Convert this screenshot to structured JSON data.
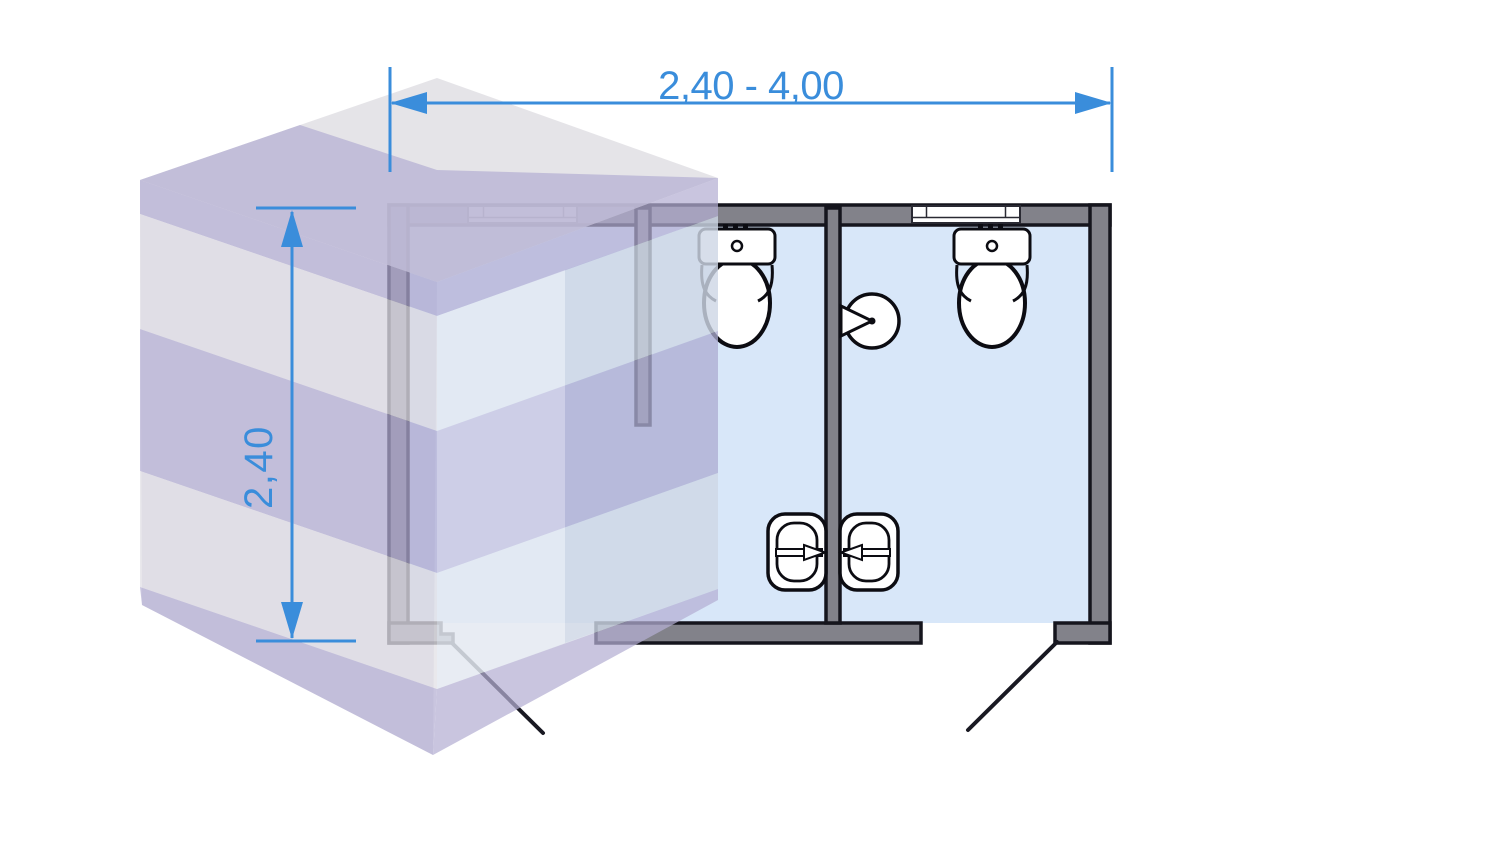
{
  "drawing": {
    "type": "sanitary-container floor plan with 3d isometric volume",
    "dimensions": {
      "width": {
        "label": "2,40 - 4,00"
      },
      "height": {
        "label": "2,40"
      }
    },
    "plan": {
      "rooms_count": 3,
      "windows_count": 2,
      "doors_count": 2,
      "fixtures": [
        {
          "name": "toilet-1"
        },
        {
          "name": "toilet-2"
        },
        {
          "name": "wash-basin-left"
        },
        {
          "name": "wash-basin-right"
        },
        {
          "name": "toilet-paper-holder"
        }
      ]
    },
    "colors": {
      "dimension_blue": "#3a8ddb",
      "wall_gray": "#82828a",
      "wall_outline": "#15151d",
      "floor_blue": "#d8e7f9",
      "cube_lavender": "#b4afd2",
      "cube_gray": "#e3e2e7",
      "cube_pale_blue": "#dde3ec",
      "fixture_white": "#ffffff",
      "fixture_outline": "#0c0c12"
    }
  }
}
